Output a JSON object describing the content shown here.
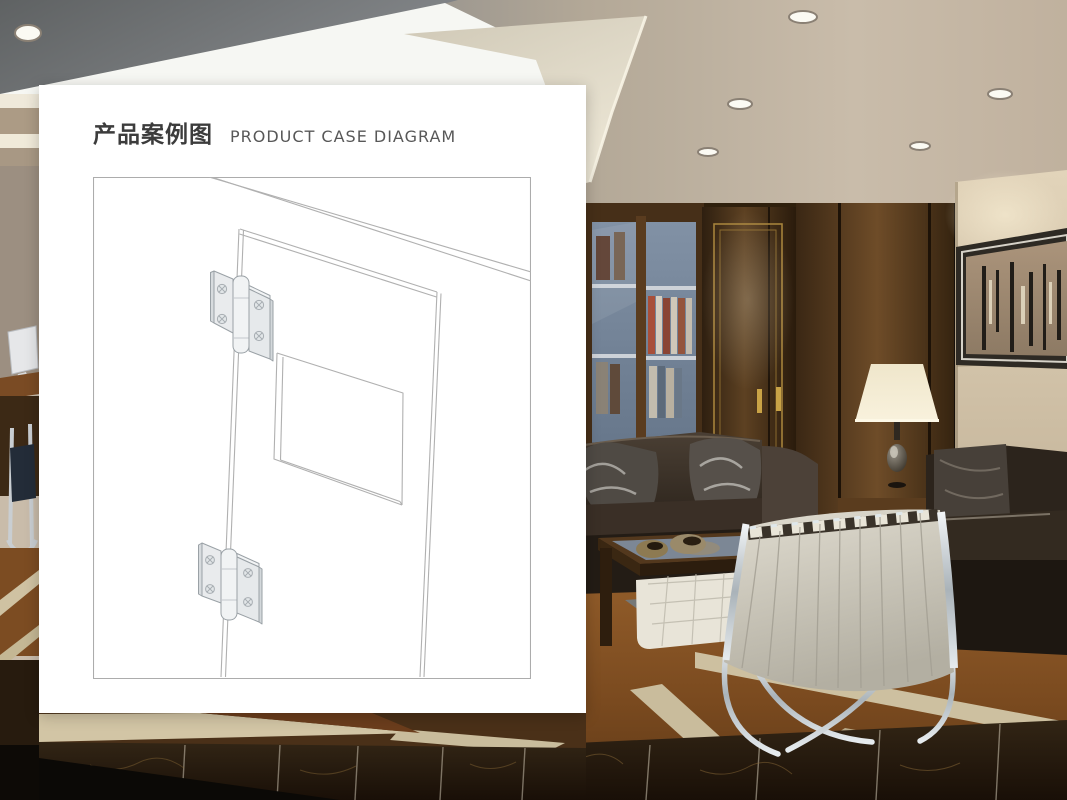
{
  "header": {
    "title_zh": "产品案例图",
    "title_en": "PRODUCT CASE DIAGRAM"
  },
  "card": {
    "background": "#ffffff",
    "description": "White overlay card containing the product case line drawing"
  },
  "diagram": {
    "description": "Isometric line drawing of a door leaf on its frame with a recessed window cutout and two butt hinges with phillips screws mounted on the hinge-side edge",
    "line_color": "#b0b0b0",
    "hinge_fill": "#e9ebed",
    "hinge_shade": "#d5d9dc",
    "hinge_count": 2,
    "screws_per_hinge": 4
  },
  "scene": {
    "description": "3D-rendered executive lounge: luminous ceiling with downlights, burl-wood wall with glass bookcase and gold-trimmed double doors, beige accent wall with abstract artwork, table lamp, espresso leather sofas, white Barcelona chair, amber marble floor with cream inlays and dark emperador foreground",
    "palette": {
      "ceiling_gray": "#8f8f8d",
      "ceiling_slab": "#6e7173",
      "luminous_panel": "#f7f7f3",
      "ceiling_beige": "#c9bcab",
      "cove_cream": "#ddd6c4",
      "wood_wall_dark": "#30200f",
      "wood_wall_mid": "#553a20",
      "gold_trim": "#a5823b",
      "glass_pane": "#8191a5",
      "accent_wall": "#d6c8b0",
      "artwork_canvas": "#a28c74",
      "lamp_shade": "#f2ead4",
      "sofa_leather": "#2f2721",
      "pillow_gray": "#4f4a44",
      "chair_leather": "#d9d5c9",
      "chrome": "#c9cdd1",
      "table_wood": "#53381d",
      "floor_amber": "#8a5526",
      "floor_inlay": "#d2c5a5",
      "floor_emperador": "#2b1e11"
    }
  }
}
